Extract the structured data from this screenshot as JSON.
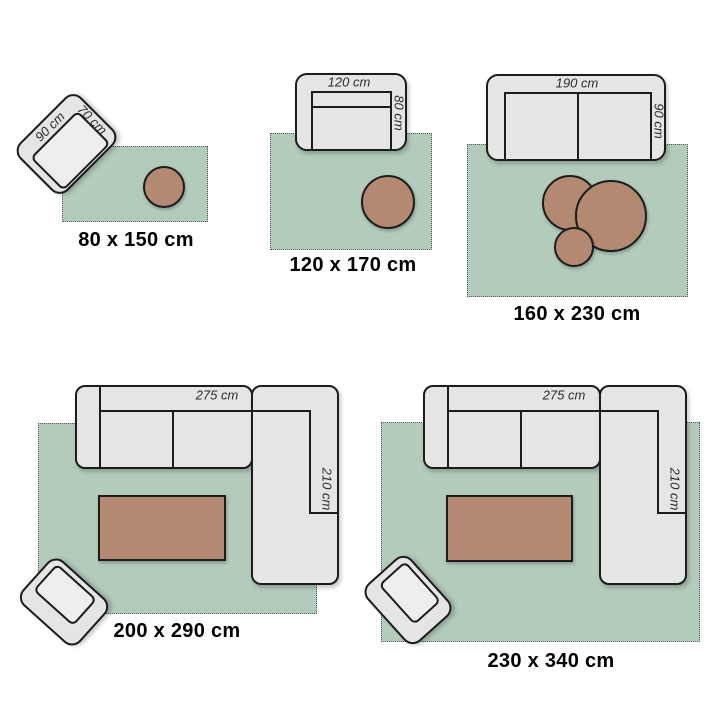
{
  "colors": {
    "background": "#ffffff",
    "rug": "#b3cbbb",
    "rug-border": "#5a5a5a",
    "furniture": "#e5e5e5",
    "seat": "#eeeeee",
    "stroke": "#1c1c1c",
    "table": "#b38a71",
    "size-label": "#000000",
    "dim-label": "#2b2b2b"
  },
  "modules": [
    {
      "size_label": "80 x 150 cm",
      "furniture": {
        "width_label": "90 cm",
        "depth_label": "70 cm"
      }
    },
    {
      "size_label": "120 x 170 cm",
      "furniture": {
        "width_label": "120 cm",
        "depth_label": "80 cm"
      }
    },
    {
      "size_label": "160 x 230 cm",
      "furniture": {
        "width_label": "190 cm",
        "depth_label": "90 cm"
      }
    },
    {
      "size_label": "200 x 290 cm",
      "furniture": {
        "width_label": "275 cm",
        "depth_label": "210 cm"
      }
    },
    {
      "size_label": "230 x 340 cm",
      "furniture": {
        "width_label": "275 cm",
        "depth_label": "210 cm"
      }
    }
  ]
}
